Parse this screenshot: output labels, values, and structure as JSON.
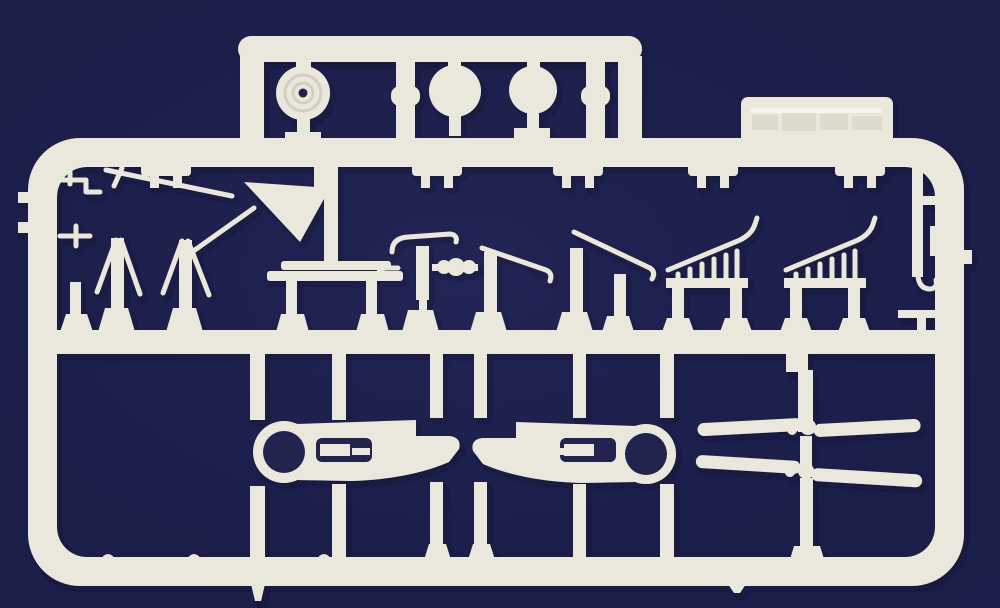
{
  "scene": {
    "type": "photograph",
    "subject": "white injection-molded plastic model-kit sprue (parts tree) on a plain dark navy background",
    "orientation": "landscape"
  },
  "colors": {
    "background": "#1c1e4b",
    "vignette": "#2a2e63",
    "plastic": "#eae7dc",
    "plastic_highlight": "#f7f5ee",
    "plastic_shade": "#d3cfbf",
    "hole": "#22244d",
    "shadow": "#0a0c28"
  },
  "sprue": {
    "material": "white polystyrene",
    "label_tab": {
      "present": true,
      "text_legible": false
    },
    "part_groups": [
      {
        "name": "wheel-with-hub",
        "count": 1
      },
      {
        "name": "round-disc",
        "count": 2
      },
      {
        "name": "a-frame-strut",
        "count": 2
      },
      {
        "name": "mast-with-boom",
        "count": 3
      },
      {
        "name": "railing-ladder",
        "count": 2
      },
      {
        "name": "engine-cowling-half",
        "count": 2
      },
      {
        "name": "two-blade-propeller",
        "count": 2
      },
      {
        "name": "plank",
        "count": 1
      },
      {
        "name": "triangular-fin",
        "count": 1
      },
      {
        "name": "small-fittings",
        "count": 9
      }
    ]
  }
}
